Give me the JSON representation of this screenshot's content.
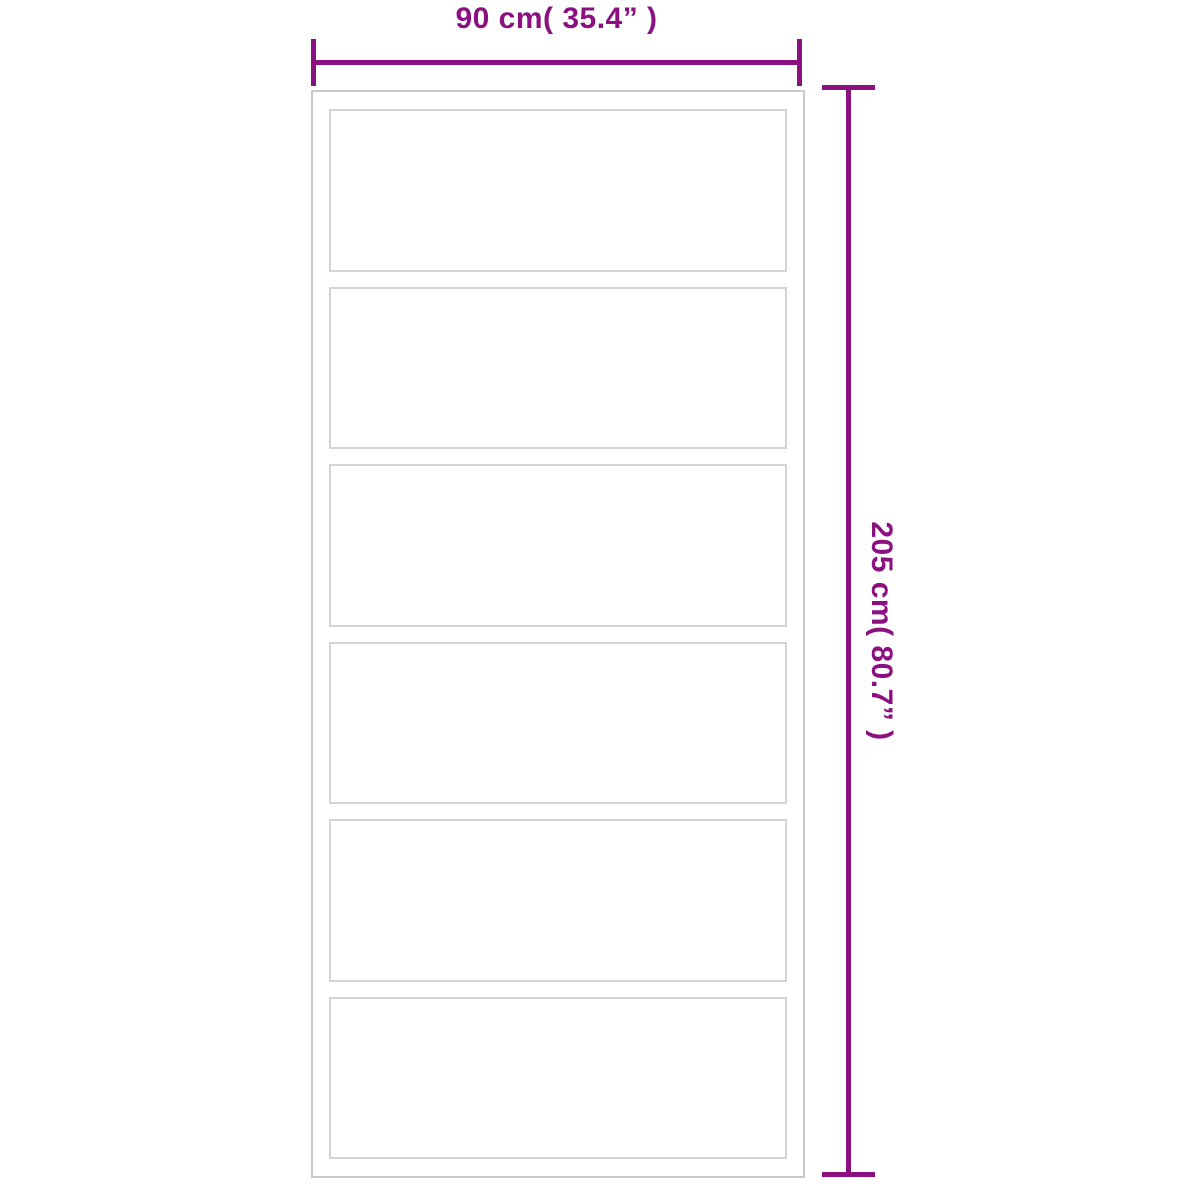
{
  "diagram": {
    "type": "product-dimension-diagram",
    "subject": "sliding-door-with-horizontal-glass-panels",
    "panel_count": 6,
    "dimensions": {
      "width_label": "90 cm( 35.4”  )",
      "height_label": "205 cm( 80.7”  )",
      "width_value_cm": 90,
      "width_value_inch": 35.4,
      "height_value_cm": 205,
      "height_value_inch": 80.7
    },
    "colors": {
      "dimension": "#8a117f",
      "frame": "#c9c9c9",
      "panel": "#d4d4d4",
      "background": "#ffffff"
    }
  }
}
